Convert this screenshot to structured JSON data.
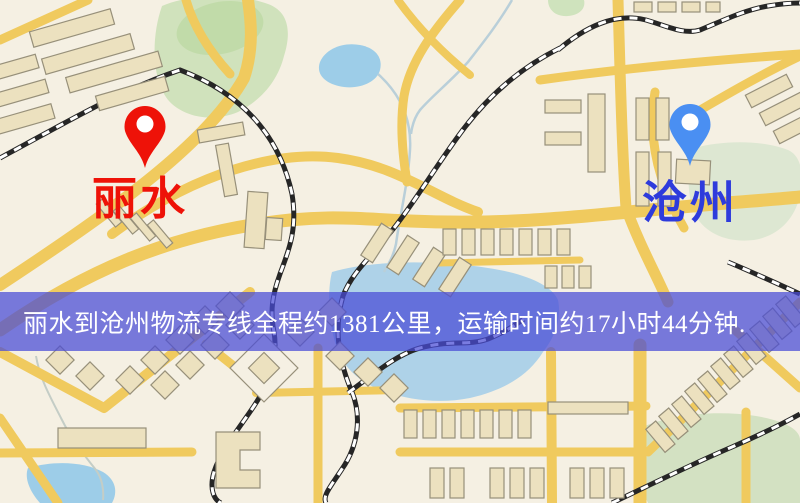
{
  "page": {
    "kind": "logistics-route-map",
    "width": 800,
    "height": 503
  },
  "map": {
    "origin": {
      "name": "丽水",
      "pin_icon": "red-location-pin",
      "pin_color": "#ee1208",
      "label_color": "#ee1208"
    },
    "destination": {
      "name": "沧州",
      "pin_icon": "blue-location-pin",
      "pin_color": "#4a8ff2",
      "label_color": "#2e3bdc"
    },
    "style_colors": {
      "background": "#f5f0e3",
      "road": "#f0ca5e",
      "building_fill": "#ece1bf",
      "building_stroke": "#97907a",
      "railway": "#262626",
      "park": "#d0e2bc",
      "water": "#9dcde8"
    }
  },
  "banner": {
    "text": "丽水到沧州物流专线全程约1381公里，运输时间约17小时44分钟.",
    "background_color": "#4a4bd6",
    "text_color": "#ffffff",
    "route": {
      "origin": "丽水",
      "destination": "沧州",
      "service": "物流专线",
      "distance": "约1381公里",
      "duration": "约17小时44分钟"
    }
  }
}
